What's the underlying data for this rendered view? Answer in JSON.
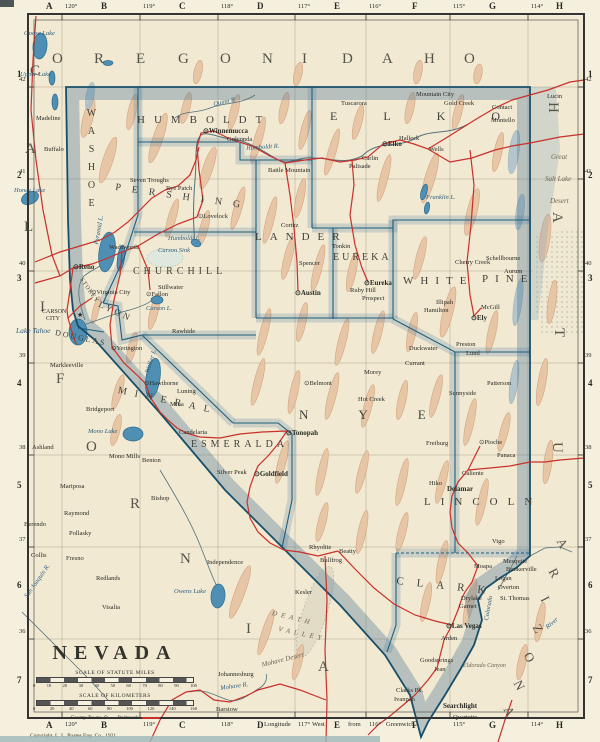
{
  "palette": {
    "paper": "#f1e9d2",
    "nevada_fill": "#f2e7cc",
    "state_line": "#174f6b",
    "county_line": "#1d6080",
    "border_band": "rgba(70,115,148,0.34)",
    "railroad_red": "#c9302b",
    "water_blue": "#4e8fb3",
    "mountain_tan": "#e7c3a2",
    "grid": "#9a937f"
  },
  "frame": {
    "column_letters": [
      {
        "t": "A",
        "x": 46
      },
      {
        "t": "B",
        "x": 101
      },
      {
        "t": "C",
        "x": 179
      },
      {
        "t": "D",
        "x": 257
      },
      {
        "t": "E",
        "x": 334
      },
      {
        "t": "F",
        "x": 412
      },
      {
        "t": "G",
        "x": 489
      },
      {
        "t": "H",
        "x": 556
      }
    ],
    "longitude_ticks": [
      {
        "t": "120°",
        "x": 62
      },
      {
        "t": "119°",
        "x": 140
      },
      {
        "t": "118°",
        "x": 218
      },
      {
        "t": "117°",
        "x": 295
      },
      {
        "t": "116°",
        "x": 366
      },
      {
        "t": "115°",
        "x": 450
      },
      {
        "t": "114°",
        "x": 528
      }
    ],
    "bottom_words": [
      {
        "t": "Longitude",
        "x": 264
      },
      {
        "t": "West",
        "x": 312
      },
      {
        "t": "from",
        "x": 348
      },
      {
        "t": "Greenwich",
        "x": 386
      }
    ],
    "row_numbers": [
      {
        "t": "1",
        "y": 70
      },
      {
        "t": "2",
        "y": 171
      },
      {
        "t": "3",
        "y": 274
      },
      {
        "t": "4",
        "y": 379
      },
      {
        "t": "5",
        "y": 481
      },
      {
        "t": "6",
        "y": 581
      },
      {
        "t": "7",
        "y": 676
      }
    ],
    "latitude_ticks": [
      {
        "t": "42",
        "y": 84
      },
      {
        "t": "41",
        "y": 176
      },
      {
        "t": "40",
        "y": 268
      },
      {
        "t": "39",
        "y": 360
      },
      {
        "t": "38",
        "y": 452
      },
      {
        "t": "37",
        "y": 544
      },
      {
        "t": "36",
        "y": 636
      }
    ]
  },
  "border_states": {
    "oregon": {
      "name": "OREGON",
      "glyphs": [
        {
          "t": "O",
          "x": 52,
          "y": 52
        },
        {
          "t": "R",
          "x": 94,
          "y": 52
        },
        {
          "t": "E",
          "x": 136,
          "y": 52
        },
        {
          "t": "G",
          "x": 178,
          "y": 52
        },
        {
          "t": "O",
          "x": 220,
          "y": 52
        },
        {
          "t": "N",
          "x": 262,
          "y": 52
        }
      ]
    },
    "idaho": {
      "name": "IDAHO",
      "glyphs": [
        {
          "t": "I",
          "x": 302,
          "y": 52
        },
        {
          "t": "D",
          "x": 342,
          "y": 52
        },
        {
          "t": "A",
          "x": 382,
          "y": 52
        },
        {
          "t": "H",
          "x": 424,
          "y": 52
        },
        {
          "t": "O",
          "x": 464,
          "y": 52
        }
      ]
    },
    "california": {
      "name": "CALIFORNIA",
      "glyphs": [
        {
          "t": "C",
          "x": 30,
          "y": 64
        },
        {
          "t": "A",
          "x": 25,
          "y": 142
        },
        {
          "t": "L",
          "x": 24,
          "y": 220
        },
        {
          "t": "I",
          "x": 40,
          "y": 300
        },
        {
          "t": "F",
          "x": 56,
          "y": 372
        },
        {
          "t": "O",
          "x": 86,
          "y": 440
        },
        {
          "t": "R",
          "x": 130,
          "y": 497
        },
        {
          "t": "N",
          "x": 180,
          "y": 552
        },
        {
          "t": "I",
          "x": 246,
          "y": 622
        },
        {
          "t": "A",
          "x": 318,
          "y": 660
        }
      ]
    },
    "utah": {
      "name": "UTAH",
      "glyphs": [
        {
          "t": "H",
          "x": 560,
          "y": 102,
          "r": 90
        },
        {
          "t": "A",
          "x": 564,
          "y": 212,
          "r": 90
        },
        {
          "t": "T",
          "x": 566,
          "y": 328,
          "r": 90
        },
        {
          "t": "U",
          "x": 564,
          "y": 442,
          "r": 90
        }
      ]
    },
    "arizona": {
      "name": "ARIZONA",
      "glyphs": [
        {
          "t": "A",
          "x": 566,
          "y": 536,
          "r": 62,
          "s": 13
        },
        {
          "t": "R",
          "x": 558,
          "y": 566,
          "r": 62,
          "s": 13
        },
        {
          "t": "I",
          "x": 550,
          "y": 594,
          "r": 62,
          "s": 13
        },
        {
          "t": "Z",
          "x": 542,
          "y": 622,
          "r": 62,
          "s": 13
        },
        {
          "t": "O",
          "x": 533,
          "y": 650,
          "r": 62,
          "s": 13
        },
        {
          "t": "N",
          "x": 523,
          "y": 678,
          "r": 62,
          "s": 13
        },
        {
          "t": "A",
          "x": 513,
          "y": 704,
          "r": 62,
          "s": 13
        }
      ]
    }
  },
  "counties": [
    {
      "n": "WASHOE",
      "x": 86,
      "y": 108,
      "s": 10,
      "sp": 7,
      "v": 1
    },
    {
      "n": "HUMBOLDT",
      "x": 137,
      "y": 115,
      "s": 11,
      "sp": 9
    },
    {
      "n": "ELKO",
      "x": 330,
      "y": 110,
      "s": 12,
      "sp": 46
    },
    {
      "n": "PERSHING",
      "x": 116,
      "y": 183,
      "s": 10,
      "sp": 11,
      "r": 8
    },
    {
      "n": "CHURCHILL",
      "x": 133,
      "y": 267,
      "s": 10,
      "sp": 4
    },
    {
      "n": "LANDER",
      "x": 255,
      "y": 232,
      "s": 11,
      "sp": 8
    },
    {
      "n": "EUREKA",
      "x": 333,
      "y": 253,
      "s": 10,
      "sp": 3
    },
    {
      "n": "WHITE",
      "x": 403,
      "y": 276,
      "s": 11,
      "sp": 7
    },
    {
      "n": "PINE",
      "x": 482,
      "y": 274,
      "s": 11,
      "sp": 7
    },
    {
      "n": "STOREY",
      "x": 83,
      "y": 277,
      "s": 6,
      "sp": 1,
      "r": 55
    },
    {
      "n": "LYON",
      "x": 101,
      "y": 300,
      "s": 9,
      "sp": 3,
      "r": 25
    },
    {
      "n": "DOUGLAS",
      "x": 56,
      "y": 329,
      "s": 8,
      "sp": 2,
      "r": 12
    },
    {
      "n": "MINERAL",
      "x": 119,
      "y": 386,
      "s": 10,
      "sp": 8,
      "r": 12
    },
    {
      "n": "ESMERALDA",
      "x": 191,
      "y": 440,
      "s": 10,
      "sp": 4
    },
    {
      "n": "NYE",
      "x": 299,
      "y": 408,
      "s": 13,
      "sp": 50
    },
    {
      "n": "LINCOLN",
      "x": 424,
      "y": 497,
      "s": 11,
      "sp": 10
    },
    {
      "n": "CLARK",
      "x": 397,
      "y": 576,
      "s": 11,
      "sp": 13,
      "r": 6
    }
  ],
  "towns": [
    {
      "n": "Winnemucca",
      "x": 203,
      "y": 128,
      "m": "seat",
      "b": 1
    },
    {
      "n": "Golconda",
      "x": 227,
      "y": 137
    },
    {
      "n": "Tuscarora",
      "x": 341,
      "y": 101
    },
    {
      "n": "Mountain City",
      "x": 416,
      "y": 92
    },
    {
      "n": "Gold Creek",
      "x": 444,
      "y": 101
    },
    {
      "n": "Contact",
      "x": 492,
      "y": 105
    },
    {
      "n": "Montello",
      "x": 491,
      "y": 118
    },
    {
      "n": "Wells",
      "x": 429,
      "y": 147
    },
    {
      "n": "Halleck",
      "x": 399,
      "y": 136
    },
    {
      "n": "Elko",
      "x": 382,
      "y": 141,
      "m": "seat",
      "b": 1
    },
    {
      "n": "Carlin",
      "x": 362,
      "y": 156
    },
    {
      "n": "Palisade",
      "x": 349,
      "y": 164
    },
    {
      "n": "Battle Mountain",
      "x": 268,
      "y": 168
    },
    {
      "n": "Rye Patch",
      "x": 166,
      "y": 186
    },
    {
      "n": "Seven Troughs",
      "x": 130,
      "y": 178
    },
    {
      "n": "Lovelock",
      "x": 198,
      "y": 214,
      "m": "seat"
    },
    {
      "n": "Reno",
      "x": 73,
      "y": 264,
      "m": "seat",
      "b": 1
    },
    {
      "n": "Wadsworth",
      "x": 109,
      "y": 245
    },
    {
      "n": "Virginia City",
      "x": 91,
      "y": 290,
      "m": "seat"
    },
    {
      "n": "CARSON",
      "x": 42,
      "y": 309,
      "s": 6
    },
    {
      "n": "CITY",
      "x": 46,
      "y": 316,
      "s": 6
    },
    {
      "n": "★",
      "x": 77,
      "y": 312,
      "s": 7
    },
    {
      "n": "Stillwater",
      "x": 158,
      "y": 285
    },
    {
      "n": "Fallon",
      "x": 146,
      "y": 292,
      "m": "seat"
    },
    {
      "n": "Rawhide",
      "x": 172,
      "y": 329
    },
    {
      "n": "Yerington",
      "x": 111,
      "y": 346,
      "m": "seat"
    },
    {
      "n": "Hawthorne",
      "x": 144,
      "y": 381,
      "m": "seat"
    },
    {
      "n": "Luning",
      "x": 177,
      "y": 389
    },
    {
      "n": "Mina",
      "x": 170,
      "y": 402
    },
    {
      "n": "Candelaria",
      "x": 179,
      "y": 430
    },
    {
      "n": "Benton",
      "x": 142,
      "y": 458
    },
    {
      "n": "Bishop",
      "x": 151,
      "y": 496
    },
    {
      "n": "Cortez",
      "x": 281,
      "y": 223
    },
    {
      "n": "Spencer",
      "x": 299,
      "y": 261
    },
    {
      "n": "Austin",
      "x": 295,
      "y": 290,
      "m": "seat",
      "b": 1
    },
    {
      "n": "Tonkin",
      "x": 332,
      "y": 244
    },
    {
      "n": "Eureka",
      "x": 364,
      "y": 280,
      "m": "seat",
      "b": 1
    },
    {
      "n": "Ruby Hill",
      "x": 350,
      "y": 288
    },
    {
      "n": "Prospect",
      "x": 362,
      "y": 296
    },
    {
      "n": "Morey",
      "x": 364,
      "y": 370
    },
    {
      "n": "Hot Creek",
      "x": 358,
      "y": 397
    },
    {
      "n": "Duckwater",
      "x": 409,
      "y": 346
    },
    {
      "n": "Currant",
      "x": 405,
      "y": 361
    },
    {
      "n": "Belmont",
      "x": 304,
      "y": 381,
      "m": "seat"
    },
    {
      "n": "Tonopah",
      "x": 286,
      "y": 430,
      "m": "seat",
      "b": 1
    },
    {
      "n": "Goldfield",
      "x": 254,
      "y": 471,
      "m": "seat",
      "b": 1
    },
    {
      "n": "Silver Peak",
      "x": 217,
      "y": 470
    },
    {
      "n": "Cherry Creek",
      "x": 455,
      "y": 260
    },
    {
      "n": "Schellbourne",
      "x": 486,
      "y": 256
    },
    {
      "n": "Aurum",
      "x": 504,
      "y": 269
    },
    {
      "n": "Illipah",
      "x": 436,
      "y": 300
    },
    {
      "n": "Hamilton",
      "x": 424,
      "y": 308
    },
    {
      "n": "McGill",
      "x": 481,
      "y": 305
    },
    {
      "n": "Ely",
      "x": 471,
      "y": 315,
      "m": "seat",
      "b": 1
    },
    {
      "n": "Preston",
      "x": 456,
      "y": 342
    },
    {
      "n": "Lund",
      "x": 466,
      "y": 351
    },
    {
      "n": "Patterson",
      "x": 487,
      "y": 381
    },
    {
      "n": "Sunnyside",
      "x": 449,
      "y": 391
    },
    {
      "n": "Freiburg",
      "x": 426,
      "y": 441
    },
    {
      "n": "Pioche",
      "x": 479,
      "y": 440,
      "m": "seat"
    },
    {
      "n": "Panaca",
      "x": 497,
      "y": 453
    },
    {
      "n": "Caliente",
      "x": 462,
      "y": 471
    },
    {
      "n": "Delamar",
      "x": 447,
      "y": 486,
      "b": 1
    },
    {
      "n": "Hiko",
      "x": 429,
      "y": 481
    },
    {
      "n": "Vigo",
      "x": 492,
      "y": 539
    },
    {
      "n": "Mesquite",
      "x": 503,
      "y": 559
    },
    {
      "n": "Bunkerville",
      "x": 506,
      "y": 567
    },
    {
      "n": "Moapa",
      "x": 474,
      "y": 564
    },
    {
      "n": "Logan",
      "x": 495,
      "y": 576
    },
    {
      "n": "Overton",
      "x": 498,
      "y": 585
    },
    {
      "n": "St. Thomas",
      "x": 500,
      "y": 596
    },
    {
      "n": "Drylake",
      "x": 461,
      "y": 596
    },
    {
      "n": "Garnet",
      "x": 459,
      "y": 604
    },
    {
      "n": "Las Vegas",
      "x": 446,
      "y": 623,
      "m": "seat",
      "b": 1
    },
    {
      "n": "Arden",
      "x": 441,
      "y": 636
    },
    {
      "n": "Goodsprings",
      "x": 420,
      "y": 658
    },
    {
      "n": "Jean",
      "x": 434,
      "y": 667
    },
    {
      "n": "Searchlight",
      "x": 443,
      "y": 703,
      "b": 1
    },
    {
      "n": "Quartette",
      "x": 453,
      "y": 715
    },
    {
      "n": "Beatty",
      "x": 339,
      "y": 549
    },
    {
      "n": "Bullfrog",
      "x": 320,
      "y": 558
    },
    {
      "n": "Rhyolite",
      "x": 309,
      "y": 545
    },
    {
      "n": "Independence",
      "x": 207,
      "y": 560
    },
    {
      "n": "Kesler",
      "x": 295,
      "y": 590
    },
    {
      "n": "Johannesburg",
      "x": 218,
      "y": 672
    },
    {
      "n": "Barstow",
      "x": 216,
      "y": 707
    },
    {
      "n": "Clarks Pk.",
      "x": 396,
      "y": 688
    },
    {
      "n": "Ivanpah",
      "x": 394,
      "y": 697
    },
    {
      "n": "Redlands",
      "x": 96,
      "y": 576
    },
    {
      "n": "Visalia",
      "x": 102,
      "y": 605
    },
    {
      "n": "Fresno",
      "x": 66,
      "y": 556
    },
    {
      "n": "Collis",
      "x": 31,
      "y": 553
    },
    {
      "n": "Berendo",
      "x": 24,
      "y": 522
    },
    {
      "n": "Pollasky",
      "x": 69,
      "y": 531
    },
    {
      "n": "Raymond",
      "x": 64,
      "y": 511
    },
    {
      "n": "Mariposa",
      "x": 60,
      "y": 484
    },
    {
      "n": "Ashland",
      "x": 32,
      "y": 445
    },
    {
      "n": "Mono Mills",
      "x": 109,
      "y": 454
    },
    {
      "n": "Bridgeport",
      "x": 86,
      "y": 407
    },
    {
      "n": "Markleeville",
      "x": 50,
      "y": 363
    },
    {
      "n": "Madeline",
      "x": 36,
      "y": 116
    },
    {
      "n": "Buffalo",
      "x": 44,
      "y": 147
    },
    {
      "n": "Lucin",
      "x": 547,
      "y": 94
    }
  ],
  "water_labels": [
    {
      "n": "Goose Lake",
      "x": 24,
      "y": 31
    },
    {
      "n": "Upper Lake",
      "x": 20,
      "y": 72
    },
    {
      "n": "Honey Lake",
      "x": 14,
      "y": 188
    },
    {
      "n": "Lake Tahoe",
      "x": 16,
      "y": 327,
      "s": 7.5
    },
    {
      "n": "Pyramid L.",
      "x": 94,
      "y": 244,
      "r": -80
    },
    {
      "n": "Carson Sink",
      "x": 158,
      "y": 248
    },
    {
      "n": "Humboldt L.",
      "x": 168,
      "y": 236
    },
    {
      "n": "Carson L.",
      "x": 146,
      "y": 306
    },
    {
      "n": "Walker L.",
      "x": 145,
      "y": 372,
      "r": -72
    },
    {
      "n": "Mono Lake",
      "x": 88,
      "y": 429
    },
    {
      "n": "Owens Lake",
      "x": 174,
      "y": 589
    },
    {
      "n": "Franklin L.",
      "x": 426,
      "y": 195
    },
    {
      "n": "Humboldt R.",
      "x": 246,
      "y": 146,
      "r": -4
    },
    {
      "n": "Quinn R.",
      "x": 213,
      "y": 102,
      "r": -12
    },
    {
      "n": "Mohave R.",
      "x": 220,
      "y": 686,
      "r": -8
    },
    {
      "n": "San Joaquin R.",
      "x": 24,
      "y": 596,
      "r": -55
    },
    {
      "n": "Colorado",
      "x": 484,
      "y": 620,
      "r": -80
    },
    {
      "n": "River",
      "x": 545,
      "y": 626,
      "r": -40
    }
  ],
  "region_labels": [
    {
      "n": "Great",
      "x": 551,
      "y": 154
    },
    {
      "n": "Salt Lake",
      "x": 545,
      "y": 176
    },
    {
      "n": "Desert",
      "x": 550,
      "y": 198
    },
    {
      "n": "DEATH",
      "x": 273,
      "y": 610,
      "r": 14,
      "sp": 4
    },
    {
      "n": "VALLEY",
      "x": 279,
      "y": 626,
      "r": 12,
      "sp": 4
    },
    {
      "n": "Mohave Desert",
      "x": 261,
      "y": 662,
      "r": -14
    },
    {
      "n": "Eldorado Canyon",
      "x": 463,
      "y": 663,
      "s": 6
    }
  ],
  "title_block": {
    "title": "NEVADA",
    "miles_caption": "SCALE OF STATUTE MILES",
    "miles_ticks": [
      "0",
      "10",
      "20",
      "30",
      "40",
      "50",
      "60",
      "70",
      "80",
      "90",
      "100"
    ],
    "km_caption": "SCALE OF KILOMETERS",
    "km_ticks": [
      "0",
      "20",
      "40",
      "60",
      "80",
      "100",
      "120",
      "140",
      "160"
    ],
    "legend_county_towns": "County Towns",
    "legend_county_symbol": "⊙",
    "legend_railroads": "Railroads"
  },
  "copyright": "Copyright, L. L. Poates Eng. Co., 1921."
}
